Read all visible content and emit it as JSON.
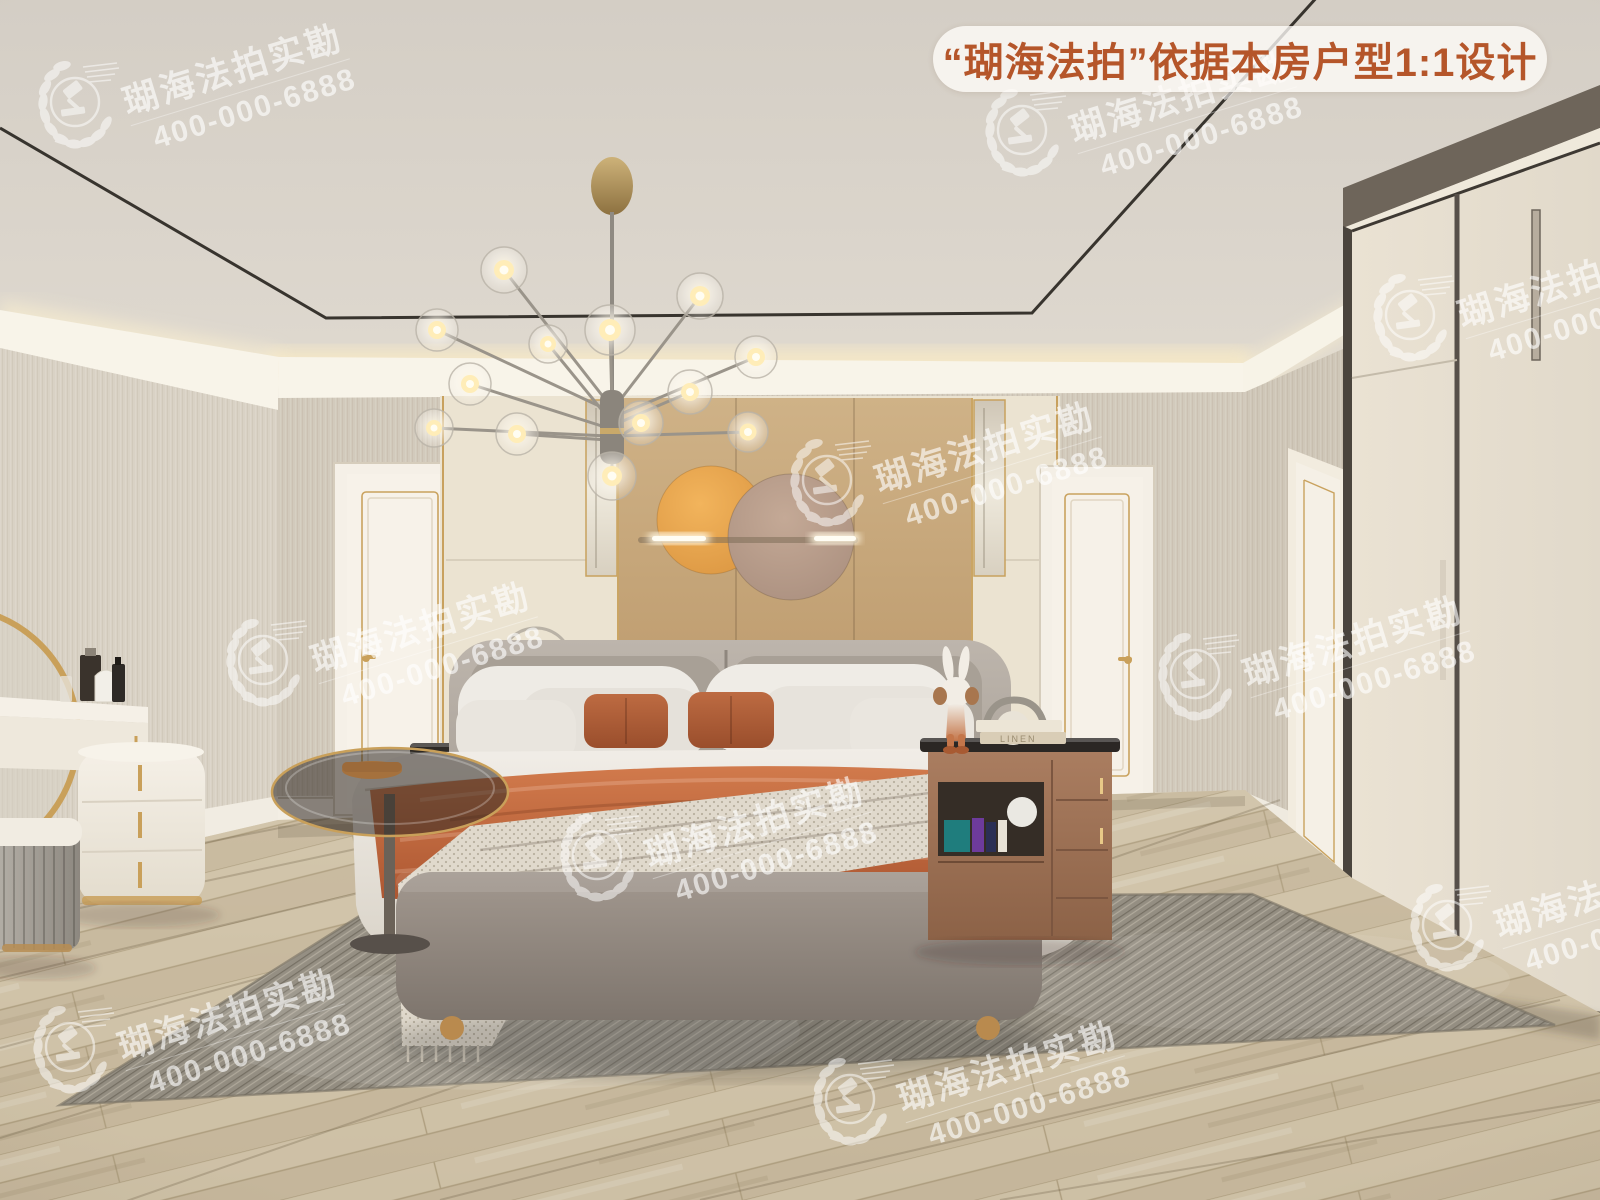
{
  "banner": {
    "text": "“瑚海法拍”依据本房户型1:1设计",
    "text_color": "#b5562a",
    "background": "rgba(255,253,248,0.78)"
  },
  "watermark": {
    "logo_icon": "gavel-laurel-logo",
    "brand_text": "瑚海法拍实勘",
    "phone": "400-000-6888",
    "color": "#ffffff"
  },
  "decor": {
    "book_spine_text": "LINEN"
  },
  "scene": {
    "type": "bedroom-interior-render",
    "palette": {
      "accent_gold": "#c9a05a",
      "wall_greige": "#d3ccbe",
      "headboard_panel_tan": "#c6a87c",
      "wall_art_orange": "#e8a84e",
      "wall_art_taupe": "#b59a8c",
      "throw_terracotta": "#c2693f",
      "rug_gray": "#938d81",
      "floor_wood": "#cdc0a7",
      "cove_light": "#fff1cc"
    },
    "objects": [
      "tray-ceiling",
      "cove-light",
      "sputnik-chandelier",
      "headboard-wall-panel",
      "wall-circles-art",
      "light-bar",
      "double-bed",
      "nightstand-left",
      "nightstand-right",
      "kaws-bunny-figurine",
      "arc-table-lamp",
      "arch-chair",
      "glass-side-table",
      "ring-sculpture",
      "vanity-dresser",
      "round-gold-mirror",
      "pleated-ottoman",
      "perfume-bottles",
      "wardrobe",
      "door-back-left",
      "door-back-right",
      "door-right-wall",
      "area-rug",
      "wood-floor"
    ]
  }
}
